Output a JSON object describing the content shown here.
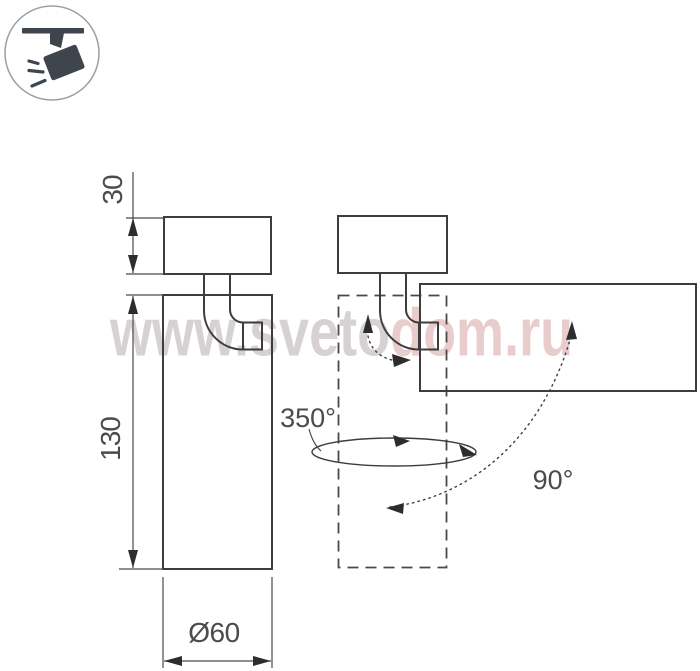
{
  "page": {
    "kind": "product technical drawing",
    "background": "#ffffff"
  },
  "watermark": {
    "left_text": "www.sveto",
    "right_text": "dom.ru",
    "full_text": "www.svetodom.ru",
    "color_gray": "#d7d2d2",
    "color_pink": "#e9cdcd"
  },
  "icon": {
    "name": "ceiling-spotlight",
    "fill_color": "#3e454d",
    "ring_color": "#9aa0a4"
  },
  "dimensions": {
    "mount_height": "30",
    "body_height": "130",
    "diameter": "Ø60"
  },
  "angles": {
    "pan_rotation": "350°",
    "tilt_rotation": "90°"
  },
  "colors": {
    "line": "#3d3d3d",
    "dimension_text": "#4b4b4b",
    "arrowhead": "#2d2d2d"
  }
}
